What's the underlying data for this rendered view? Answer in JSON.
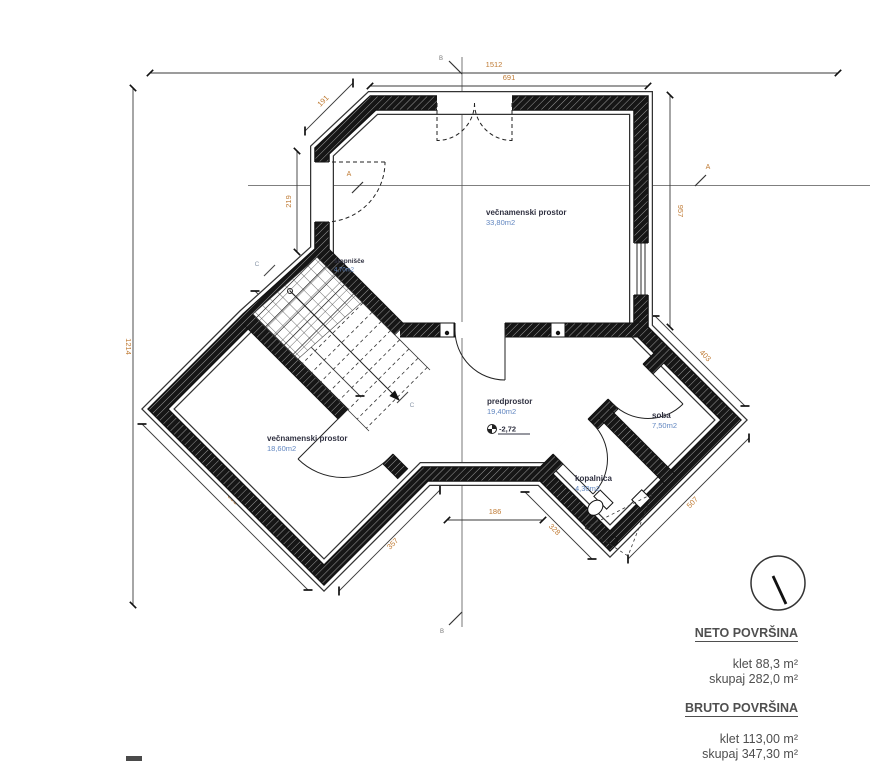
{
  "drawing": {
    "rooms": [
      {
        "id": "top",
        "name": "večnamenski prostor",
        "area": "33,80m2"
      },
      {
        "id": "stairs",
        "name": "stopnišče",
        "area": "4,70m2"
      },
      {
        "id": "left",
        "name": "večnamenski prostor",
        "area": "18,60m2"
      },
      {
        "id": "hall",
        "name": "predprostor",
        "area": "19,40m2"
      },
      {
        "id": "soba",
        "name": "soba",
        "area": "7,50m2"
      },
      {
        "id": "bath",
        "name": "kopalnica",
        "area": "4,30m2"
      }
    ],
    "level_marker": "-2,72",
    "dimensions": {
      "total_width": "1512",
      "top_wall": "691",
      "left_total": "1214",
      "right_wall": "957",
      "chamfer": "191",
      "left_door_wall": "219",
      "stair_wall": "525",
      "left_wing_sw": "658",
      "left_wing_se": "357",
      "hall_bottom": "186",
      "right_wing_sw": "328",
      "right_wing_se": "507",
      "right_wing_ne": "403"
    },
    "section_labels": {
      "a": "A",
      "b": "B",
      "c": "C"
    }
  },
  "summary": {
    "neto": {
      "title": "NETO POVRŠINA",
      "rows": [
        "klet 88,3 m²",
        "skupaj 282,0 m²"
      ]
    },
    "bruto": {
      "title": "BRUTO POVRŠINA",
      "rows": [
        "klet 113,00 m²",
        "skupaj 347,30 m²"
      ]
    }
  },
  "colors": {
    "wall": "#161616",
    "line": "#3a3a3a",
    "dim_text": "#bf7a33",
    "area_text": "#6186c0",
    "room_text": "#2f3040",
    "summary_text": "#4f4f4f",
    "section_text": "#8a97a8"
  }
}
